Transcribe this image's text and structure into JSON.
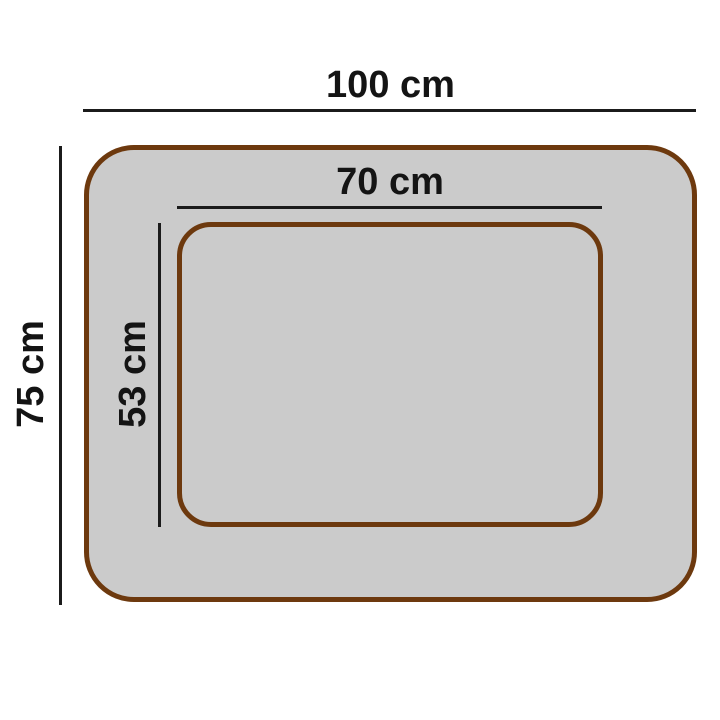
{
  "diagram": {
    "kind": "product-dimension-diagram",
    "outer": {
      "width_label": "100 cm",
      "height_label": "75 cm"
    },
    "inner": {
      "width_label": "70 cm",
      "height_label": "53 cm"
    },
    "colors": {
      "background": "#ffffff",
      "bed_fill": "#cbcbcb",
      "bed_border": "#6d390e",
      "dimension_line": "#1b1b1b",
      "label_text": "#141414"
    }
  }
}
